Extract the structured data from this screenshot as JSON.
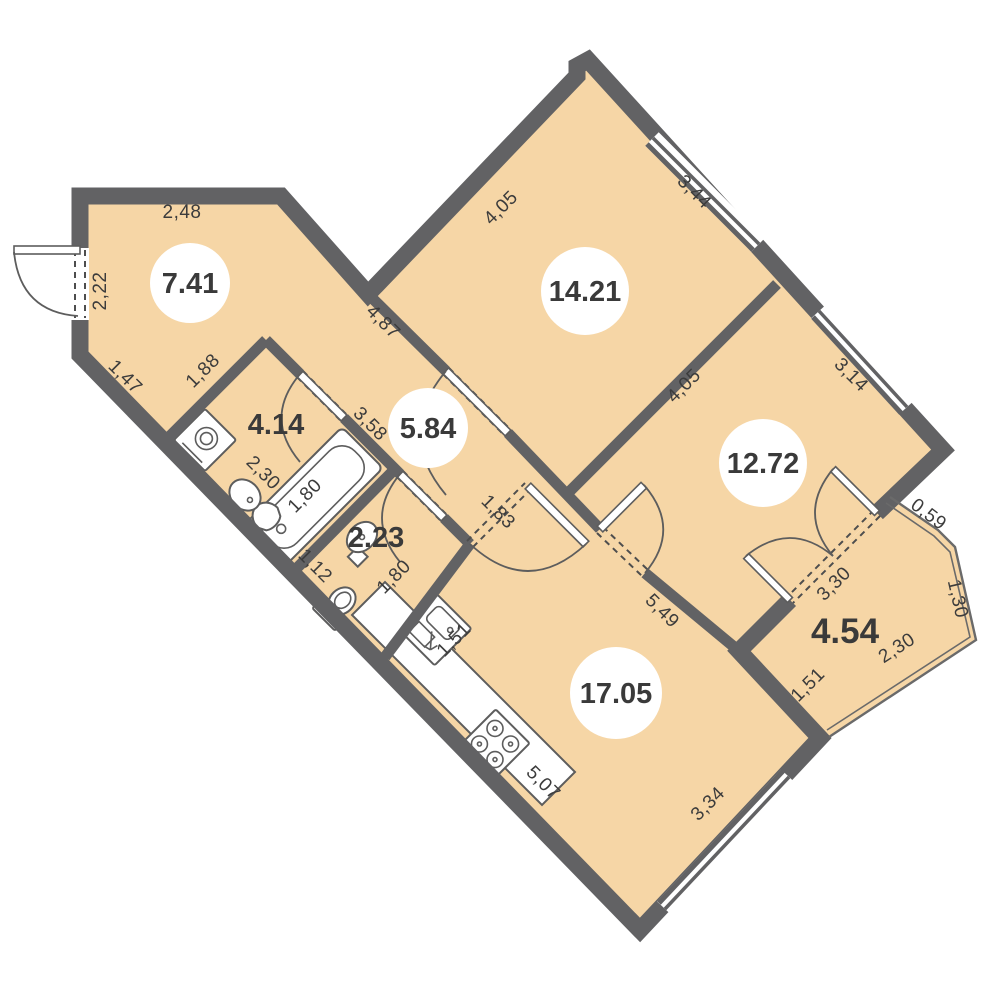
{
  "palette": {
    "floor": "#f6d6a6",
    "wall": "#626264",
    "line": "#5d5d5d",
    "text": "#3c3c3c",
    "label_bg": "#ffffff"
  },
  "rooms": [
    {
      "name": "entry-hall",
      "area": "7.41"
    },
    {
      "name": "bedroom-1",
      "area": "14.21"
    },
    {
      "name": "bedroom-2",
      "area": "12.72"
    },
    {
      "name": "hallway",
      "area": "5.84"
    },
    {
      "name": "bathroom",
      "area": "4.14"
    },
    {
      "name": "wc",
      "area": "2.23"
    },
    {
      "name": "kitchen-living",
      "area": "17.05"
    },
    {
      "name": "balcony",
      "area": "4.54"
    }
  ],
  "dims": [
    "2,48",
    "2,22",
    "1,47",
    "1,88",
    "4,87",
    "4,05",
    "3,44",
    "4,05",
    "3,14",
    "3,58",
    "2,30",
    "1,80",
    "1,12",
    "1,80",
    "1,83",
    "5,49",
    "3,30",
    "0,59",
    "1,30",
    "2,30",
    "1,51",
    "1,51",
    "5,07",
    "3,34"
  ],
  "icons": [
    "entry-door",
    "bath-door",
    "wc-door",
    "bedroom1-door",
    "kitchen-door",
    "bedroom2-door",
    "balcony-french-door",
    "window",
    "bathtub",
    "sink",
    "washing-machine",
    "toilet",
    "kitchen-sink",
    "stove"
  ]
}
